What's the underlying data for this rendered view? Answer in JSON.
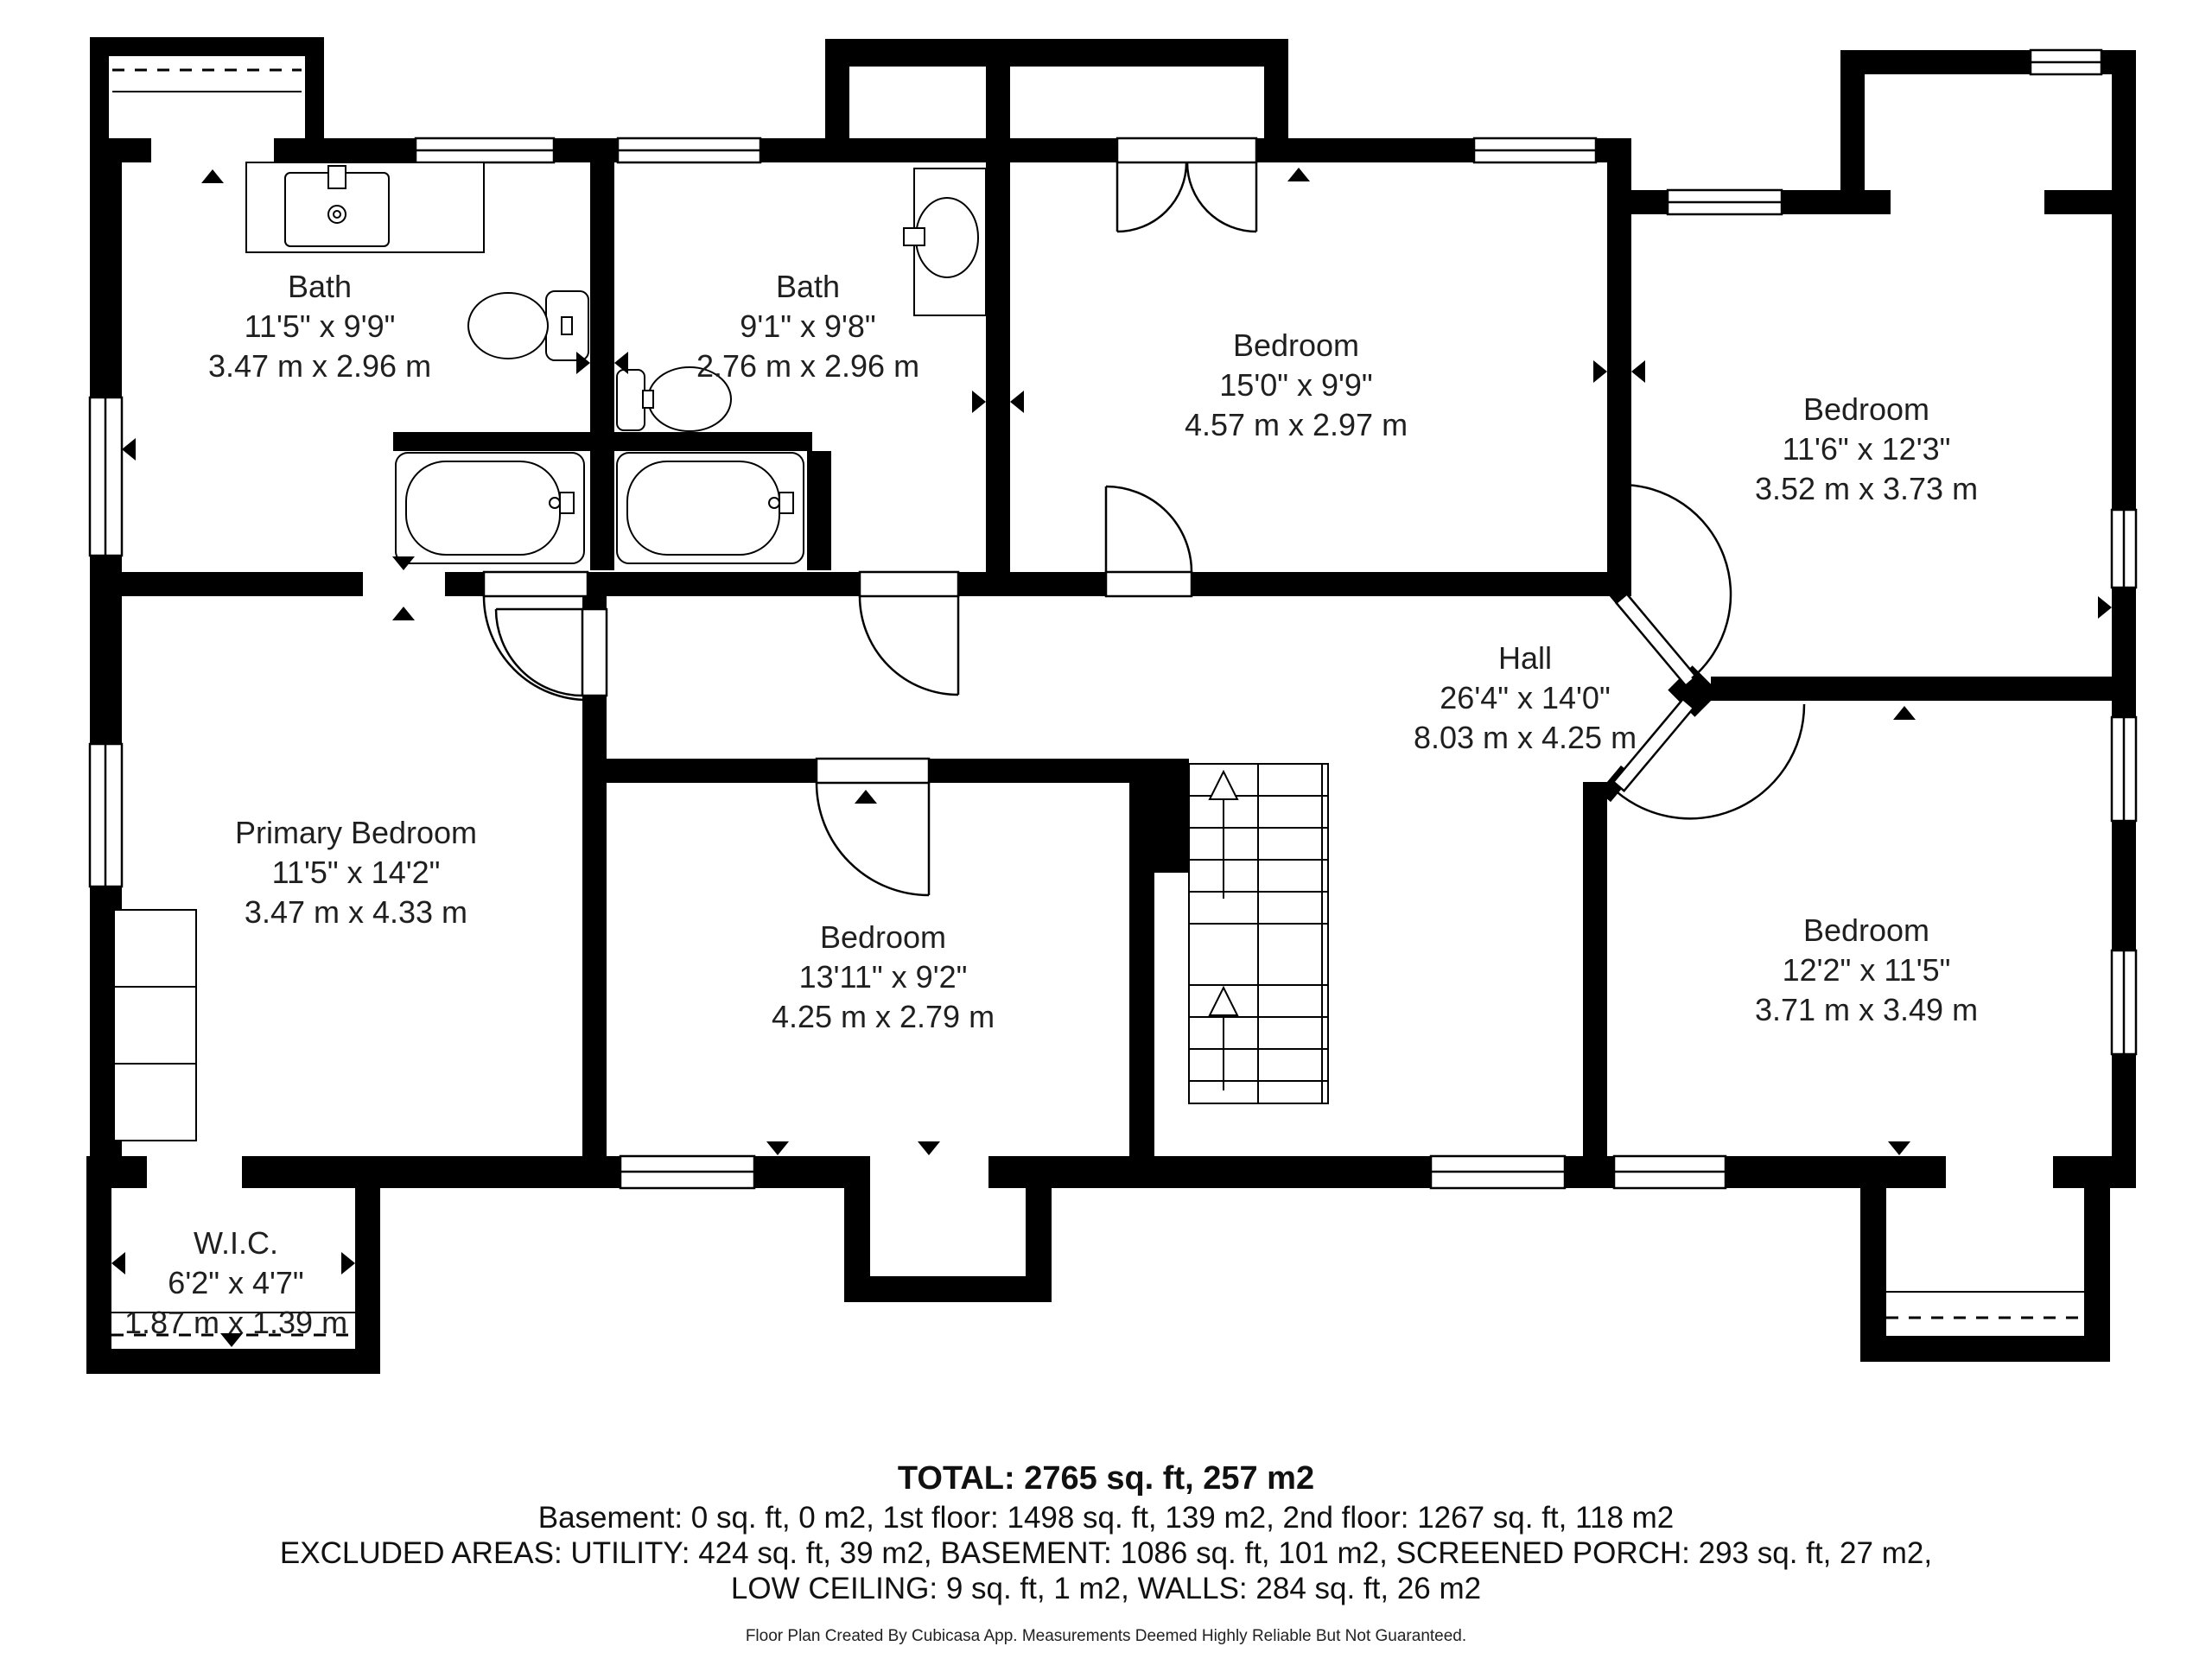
{
  "rooms": [
    {
      "name": "Bath",
      "imperial": "11'5\" x 9'9\"",
      "metric": "3.47 m x 2.96 m"
    },
    {
      "name": "Bath",
      "imperial": "9'1\" x 9'8\"",
      "metric": "2.76 m x 2.96 m"
    },
    {
      "name": "Bedroom",
      "imperial": "15'0\" x 9'9\"",
      "metric": "4.57 m x 2.97 m"
    },
    {
      "name": "Bedroom",
      "imperial": "11'6\" x 12'3\"",
      "metric": "3.52 m x 3.73 m"
    },
    {
      "name": "Hall",
      "imperial": "26'4\" x 14'0\"",
      "metric": "8.03 m x 4.25 m"
    },
    {
      "name": "Primary Bedroom",
      "imperial": "11'5\" x 14'2\"",
      "metric": "3.47 m x 4.33 m"
    },
    {
      "name": "Bedroom",
      "imperial": "13'11\" x 9'2\"",
      "metric": "4.25 m x 2.79 m"
    },
    {
      "name": "Bedroom",
      "imperial": "12'2\" x 11'5\"",
      "metric": "3.71 m x 3.49 m"
    },
    {
      "name": "W.I.C.",
      "imperial": "6'2\" x 4'7\"",
      "metric": "1.87 m x 1.39 m"
    }
  ],
  "summary": {
    "total": "TOTAL: 2765 sq. ft, 257 m2",
    "floors": "Basement: 0 sq. ft, 0 m2, 1st floor: 1498 sq. ft, 139 m2, 2nd floor: 1267 sq. ft, 118 m2",
    "excluded_line1": "EXCLUDED AREAS: UTILITY: 424 sq. ft, 39 m2, BASEMENT: 1086 sq. ft, 101 m2, SCREENED PORCH: 293 sq. ft, 27 m2,",
    "excluded_line2": "LOW CEILING: 9 sq. ft, 1 m2, WALLS: 284 sq. ft, 26 m2",
    "footer": "Floor Plan Created By Cubicasa App. Measurements Deemed Highly Reliable But Not Guaranteed."
  },
  "colors": {
    "wall": "#000000",
    "text": "#1f1f1f"
  }
}
